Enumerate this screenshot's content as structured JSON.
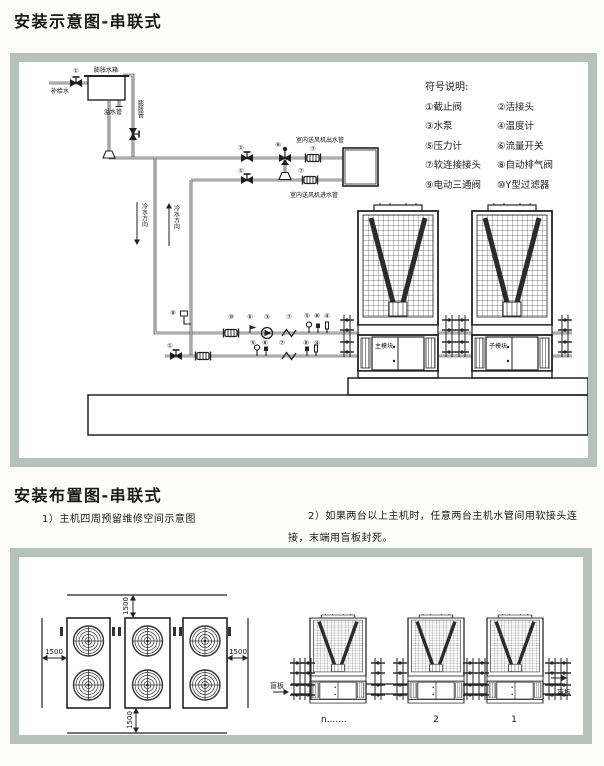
{
  "section1": {
    "title": "安装示意图-串联式"
  },
  "section2": {
    "title": "安装布置图-串联式",
    "note1": "1）主机四周预留维修空间示意图",
    "note2_line1": "2）如果两台以上主机时，任意两台主机水管间用软接头连",
    "note2_line2": "接，末端用盲板封死。"
  },
  "colors": {
    "frame": "#b7c1bb",
    "line": "#222222"
  },
  "legend": {
    "title": "符号说明:",
    "rows": [
      [
        "①截止阀",
        "②活接头"
      ],
      [
        "③水泵",
        "④温度计"
      ],
      [
        "⑤压力计",
        "⑥流量开关"
      ],
      [
        "⑦软连接接头",
        "⑧自动排气阀"
      ],
      [
        "⑨电动三通阀",
        "⑩Y型过滤器"
      ]
    ]
  },
  "schematic": {
    "tank": "膨胀水箱",
    "supply": "补给水",
    "overflow": "溢水管",
    "expansion": "膨胀管",
    "outlet_pipe": "室内送风机出水管",
    "inlet_pipe": "室内送风机进水管",
    "flow_down": "冷水方向",
    "flow_up": "冷水方向",
    "main_module": "主模块",
    "sub_module": "子模块",
    "marks": {
      "supply_valve": "①",
      "outlet_valve": "①",
      "inlet_valve": "①",
      "three_way": "⑨",
      "flex_top": "⑦",
      "flex_bottom": "⑦",
      "riser_vent": "⑧",
      "filter": "⑩",
      "flow_switch": "⑥",
      "pump": "③",
      "flex_supply": "⑦",
      "pressure_supply": "⑤",
      "vent_supply": "⑧",
      "thermo_supply": "④",
      "drain_valve": "①",
      "pressure_return": "⑤",
      "vent_return": "⑧",
      "flex_return": "⑦",
      "vent_return2": "⑧",
      "thermo_return": "④"
    }
  },
  "layout": {
    "dim_top": "1500",
    "dim_left": "1500",
    "dim_right": "1500",
    "dim_bottom": "1500",
    "blind_left": "盲板",
    "blind_right": "盲板",
    "labels": [
      "n.......",
      "2",
      "1"
    ]
  }
}
